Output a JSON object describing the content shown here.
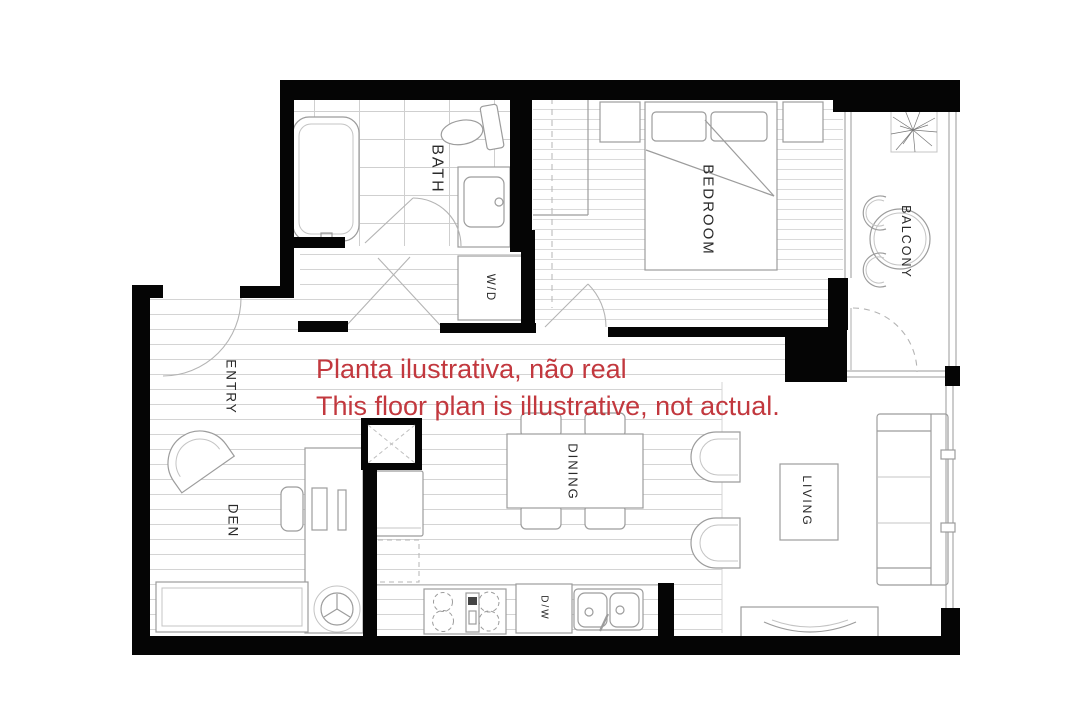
{
  "title": "Apartment floor plan",
  "colors": {
    "walls": "#050505",
    "floor_lines": "#d4d4d4",
    "furniture_outline": "#9c9c9c",
    "label_text": "#2a2a2a",
    "annotation_red": "#c2383e",
    "background": "#ffffff"
  },
  "rooms": {
    "bath": {
      "label": "BATH"
    },
    "bedroom": {
      "label": "BEDROOM"
    },
    "balcony": {
      "label": "BALCONY"
    },
    "entry": {
      "label": "ENTRY"
    },
    "den": {
      "label": "DEN"
    },
    "dining": {
      "label": "DINING"
    },
    "living": {
      "label": "LIVING"
    }
  },
  "fixtures": {
    "washer_dryer": {
      "label": "W/D"
    },
    "dishwasher": {
      "label": "D/W"
    }
  },
  "annotation": {
    "line1": "Planta ilustrativa, não real",
    "line2": "This floor plan is illustrative, not actual."
  }
}
